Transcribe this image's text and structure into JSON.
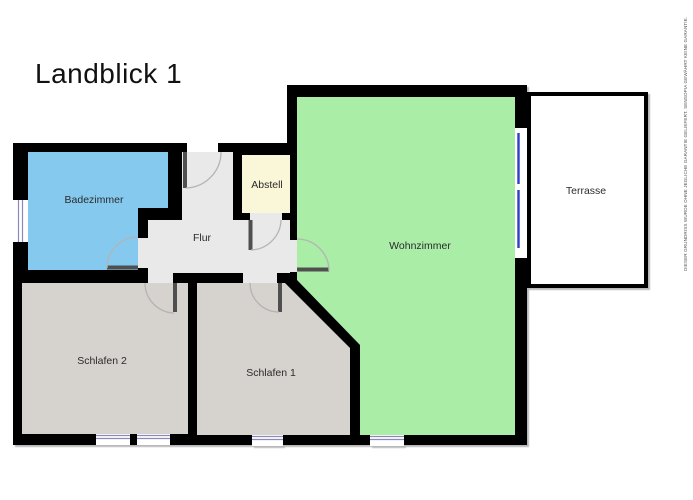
{
  "title": "Landblick 1",
  "watermark": "DIESER GRUNDRISS WURDE OHNE JEGLICHE GARANTIE GELIEFERT. SENSOPIA GEWÄHRT KEINE GARANTIE.",
  "rooms": {
    "badezimmer": {
      "label": "Badezimmer",
      "color": "#85c9ef"
    },
    "flur": {
      "label": "Flur",
      "color": "#e9e9e9"
    },
    "abstell": {
      "label": "Abstell",
      "color": "#faf6d8"
    },
    "wohnzimmer": {
      "label": "Wohnzimmer",
      "color": "#a9eda7"
    },
    "terrasse": {
      "label": "Terrasse",
      "color": "#ffffff"
    },
    "schlafen2": {
      "label": "Schlafen 2",
      "color": "#d6d2cd"
    },
    "schlafen1": {
      "label": "Schlafen 1",
      "color": "#d6d2cd"
    }
  },
  "palette": {
    "wall": "#000000",
    "flur_gap": "#e9e9e9",
    "door_leaf": "#4f4f4f",
    "door_arc": "#b4b4b4",
    "window_blue": "#2e3ec8",
    "window_thin": "#8a8ab8",
    "label": "#2b2b2b"
  }
}
